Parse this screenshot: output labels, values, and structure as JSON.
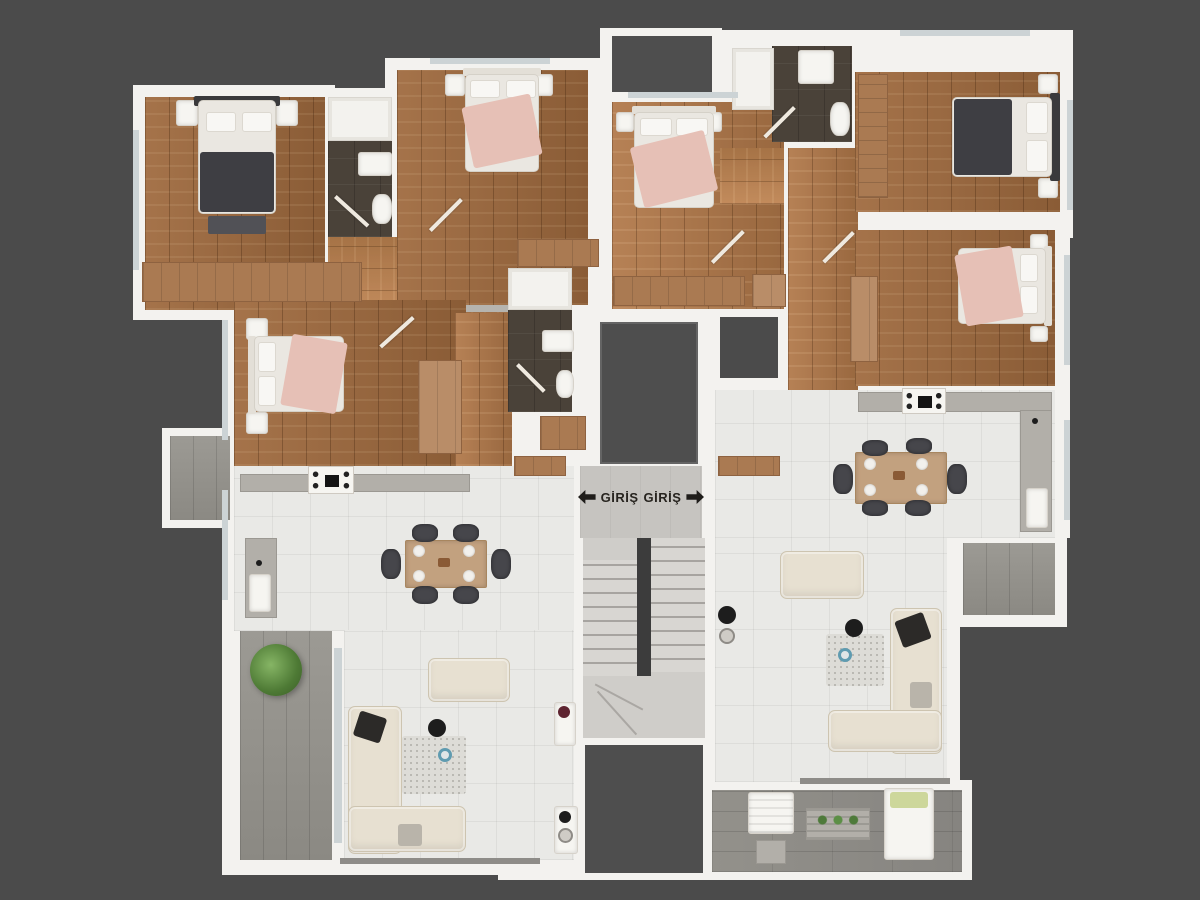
{
  "scene": {
    "width": 1200,
    "height": 900,
    "background": "#4b4b4b"
  },
  "entrance": {
    "label_left": "GİRİŞ",
    "label_right": "GİRİŞ",
    "arrow_left_icon": "left-arrow",
    "arrow_right_icon": "right-arrow"
  },
  "palette": {
    "wall": "#f3f2ef",
    "wood_floor": "#9a6a42",
    "tile_light": "#e9e9e6",
    "tile_dark_bath": "#4a4239",
    "concrete_balcony": "#96948e",
    "corridor_gray": "#c6c4c0",
    "shaft_dark": "#4e4e4e",
    "pink_bedding": "#e6c0b6",
    "dark_bedding": "#3e3e43",
    "cream_sofa": "#e7e0d1",
    "dining_table": "#c2a17f",
    "chair": "#46464b",
    "dresser_wood": "#aa7a52",
    "plant_green": "#5c8f46",
    "stair_tread": "#d8d6d2"
  }
}
